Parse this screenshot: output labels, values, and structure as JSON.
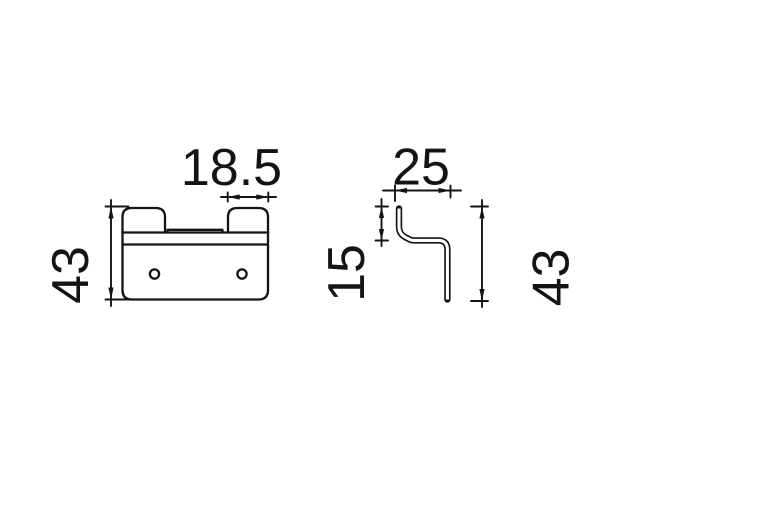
{
  "colors": {
    "background": "#ffffff",
    "ink": "#141414"
  },
  "drawing": {
    "kind": "technical-dimension-drawing",
    "views": {
      "front": "front-view-of-hook-bracket",
      "side": "side-profile-of-hook-bracket"
    }
  },
  "dims": {
    "tab_width": "18.5",
    "front_height": "43",
    "depth": "25",
    "offset": "15",
    "side_height": "43"
  }
}
